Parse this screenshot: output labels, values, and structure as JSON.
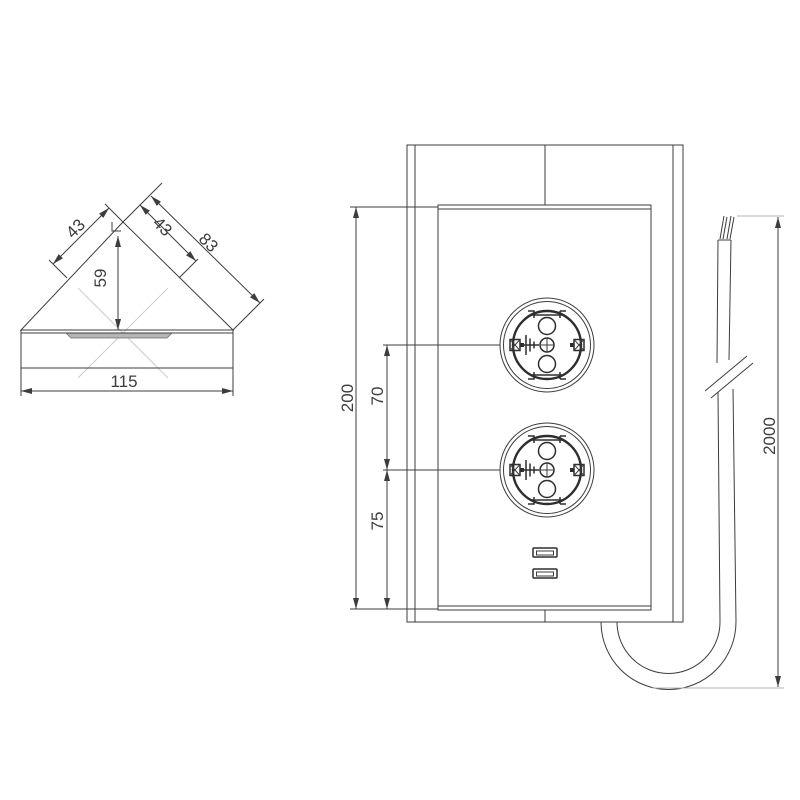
{
  "drawing": {
    "background": "#ffffff",
    "line_color": "#3d3d3d",
    "light_line_color": "#cccccc",
    "views": {
      "corner_top_view": {
        "dimensions": {
          "left_edge": "43",
          "right_edge_inner": "43",
          "right_edge_total": "83",
          "height": "59",
          "base_width": "115"
        }
      },
      "front_view": {
        "dimensions": {
          "panel_height": "200",
          "socket_center_spacing": "70",
          "lower_socket_to_bottom": "75"
        },
        "socket_count": 2,
        "usb_port_count": 2
      },
      "cable": {
        "dimensions": {
          "length": "2000"
        }
      }
    }
  }
}
